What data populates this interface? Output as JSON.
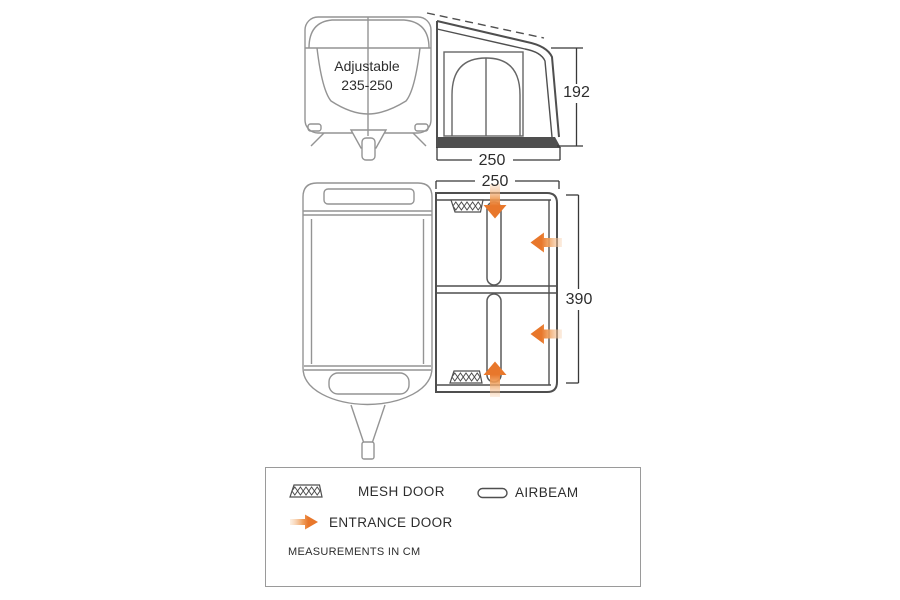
{
  "colors": {
    "background": "#ffffff",
    "diagram_line_light": "#949494",
    "diagram_line_dark": "#4f4f4f",
    "dimension_line": "#383838",
    "text": "#2d2d2d",
    "arrow_head": "#e8772b",
    "arrow_mid": "#ef9b55",
    "arrow_tail": "#f8d8ba"
  },
  "front_view": {
    "caravan_label_line1": "Adjustable",
    "caravan_label_line2": "235-250",
    "awning_height_cm": "192",
    "awning_width_cm": "250"
  },
  "plan_view": {
    "awning_width_cm": "250",
    "awning_depth_cm": "390"
  },
  "legend": {
    "mesh_door_label": "MESH DOOR",
    "airbeam_label": "AIRBEAM",
    "entrance_door_label": "ENTRANCE DOOR",
    "measurements_note": "MEASUREMENTS IN CM"
  }
}
